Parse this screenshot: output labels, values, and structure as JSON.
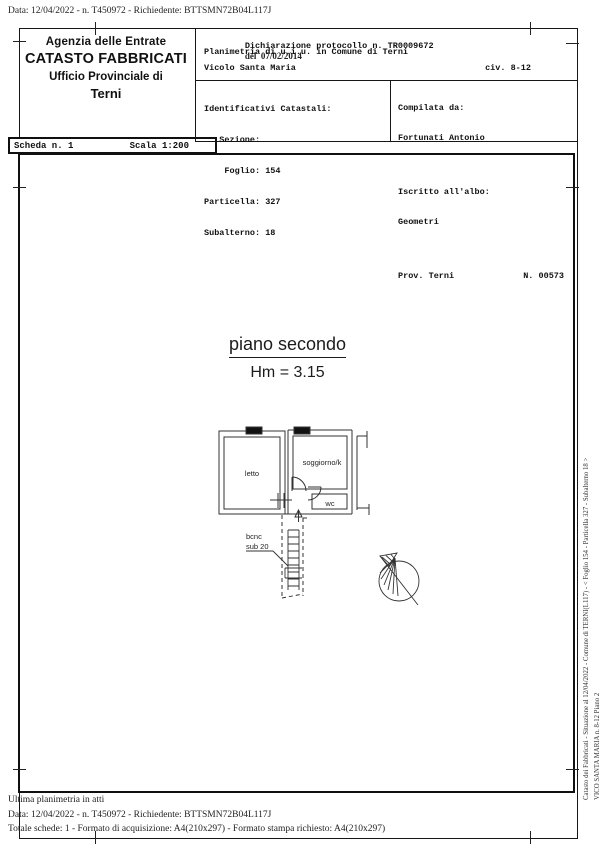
{
  "page": {
    "top_line": "Data: 12/04/2022 - n. T450972 - Richiedente: BTTSMN72B04L117J",
    "footer": {
      "ultima": "Ultima planimetria in atti",
      "data_line": "Data: 12/04/2022 - n. T450972 - Richiedente: BTTSMN72B04L117J",
      "totale_line": "Totale schede: 1 - Formato di acquisizione: A4(210x297) - Formato stampa richiesto: A4(210x297)"
    },
    "side_text": {
      "line1": "Catasto dei Fabbricati - Situazione al 12/04/2022 - Comune di TERNI(L117) - < Foglio 154 - Particella 327 - Subalterno 18 >",
      "line2": "VICO SANTA MARIA n. 8-12 Piano 2"
    }
  },
  "header": {
    "agency": {
      "line1": "Agenzia delle Entrate",
      "line2": "CATASTO FABBRICATI",
      "line3": "Ufficio Provinciale di",
      "line4": "Terni"
    },
    "scheda": {
      "scheda": "Scheda n. 1",
      "scala": "Scala 1:200"
    },
    "declaration": {
      "protocol": "Dichiarazione protocollo n. TR0009672",
      "protocol_date": "del  07/02/2014",
      "line2": "Planimetria di u.i.u. in Comune di Terni",
      "street": "Vicolo Santa Maria",
      "civ": "civ. 8-12"
    },
    "identificativi": {
      "title": "Identificativi Catastali:",
      "lines": [
        "   Sezione:",
        "    Foglio: 154",
        "Particella: 327",
        "Subalterno: 18"
      ]
    },
    "compilata": {
      "label": "Compilata da:",
      "name": "Fortunati Antonio",
      "albo_label": "Iscritto all'albo:",
      "albo": "Geometri",
      "prov": "Prov. Terni",
      "num": "N. 00573"
    }
  },
  "plan": {
    "floor_title": "piano secondo",
    "height_label": "Hm = 3.15",
    "rooms": {
      "letto": "letto",
      "soggiorno": "soggiorno/k",
      "wc": "wc"
    },
    "bcnc": {
      "line1": "bcnc",
      "line2": "sub 20"
    },
    "icons": {
      "north_arrow": "north-arrow-icon"
    },
    "ink_color": "#1a1a1a"
  }
}
